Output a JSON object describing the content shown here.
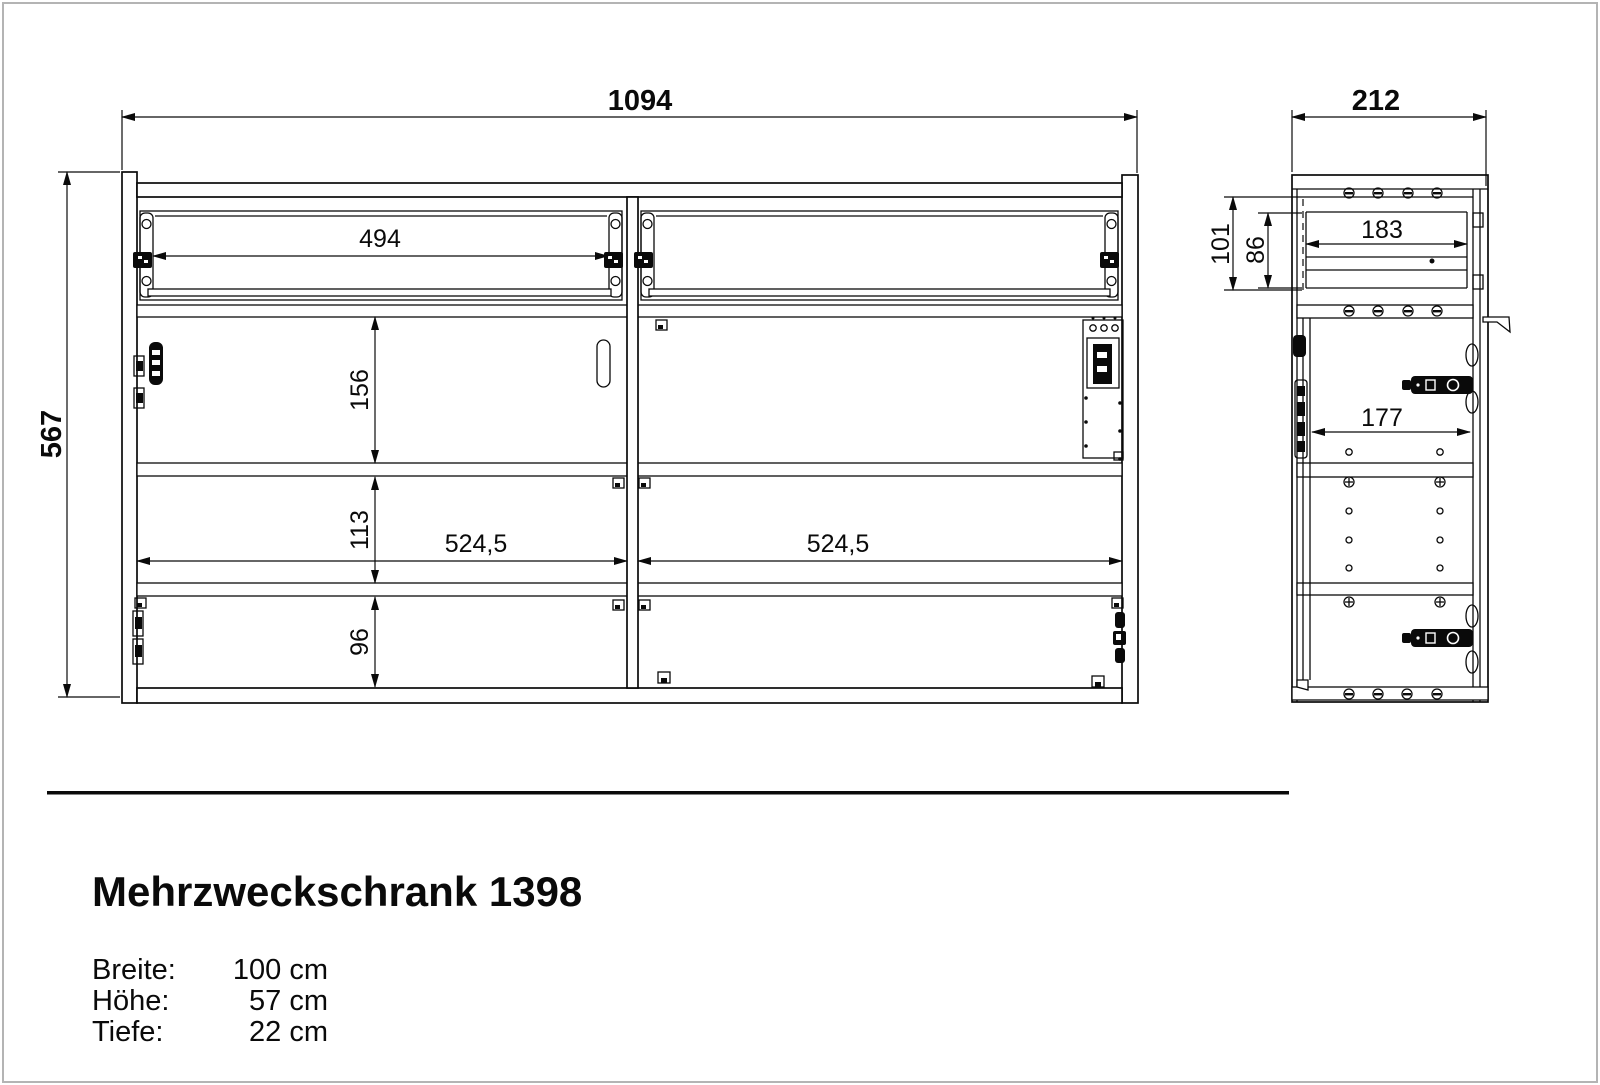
{
  "dims": {
    "front": {
      "width": "1094",
      "height": "567",
      "drawer_opening_width": "494",
      "top_compartment_height": "156",
      "middle_compartment_height": "113",
      "bottom_compartment_height": "96",
      "left_compartment_width": "524,5",
      "right_compartment_width": "524,5"
    },
    "side": {
      "depth": "212",
      "drawer_zone_height": "101",
      "drawer_front_height": "86",
      "drawer_depth": "183",
      "door_inner_depth": "177"
    }
  },
  "info": {
    "title": "Mehrzweckschrank 1398",
    "specs": [
      {
        "label": "Breite:",
        "value": "100 cm"
      },
      {
        "label": "Höhe:",
        "value": "57 cm"
      },
      {
        "label": "Tiefe:",
        "value": "22 cm"
      }
    ]
  }
}
